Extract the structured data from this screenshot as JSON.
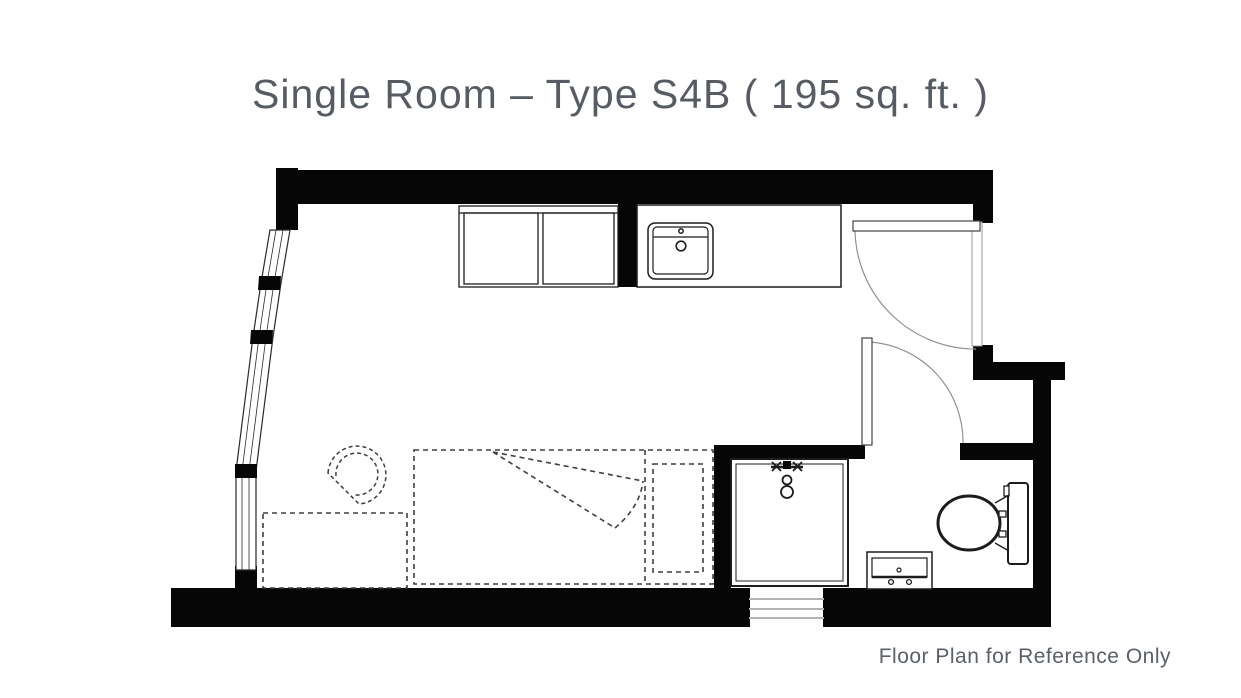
{
  "page": {
    "background_color": "#ffffff",
    "title": "Single Room – Type S4B ( 195 sq. ft. )",
    "title_color": "#565b64",
    "footer_note": "Floor Plan for Reference Only",
    "footer_color": "#5a5f68"
  },
  "plan": {
    "wall_color": "#060606",
    "outline_color": "#1c1c1c",
    "window_line_color": "#2a2a2a",
    "door_arc_color": "#909090",
    "door_frame_color": "#9a9a9a",
    "dashed_color": "#3f3f3f",
    "step_color": "#b3b3b3",
    "fixtures": [
      "window-wall",
      "wardrobe",
      "kitchen-counter",
      "kitchen-sink",
      "entry-door",
      "bathroom-door",
      "shower",
      "shower-mixer",
      "vanity",
      "toilet",
      "bed",
      "pillow",
      "desk",
      "chair",
      "entry-steps"
    ]
  }
}
